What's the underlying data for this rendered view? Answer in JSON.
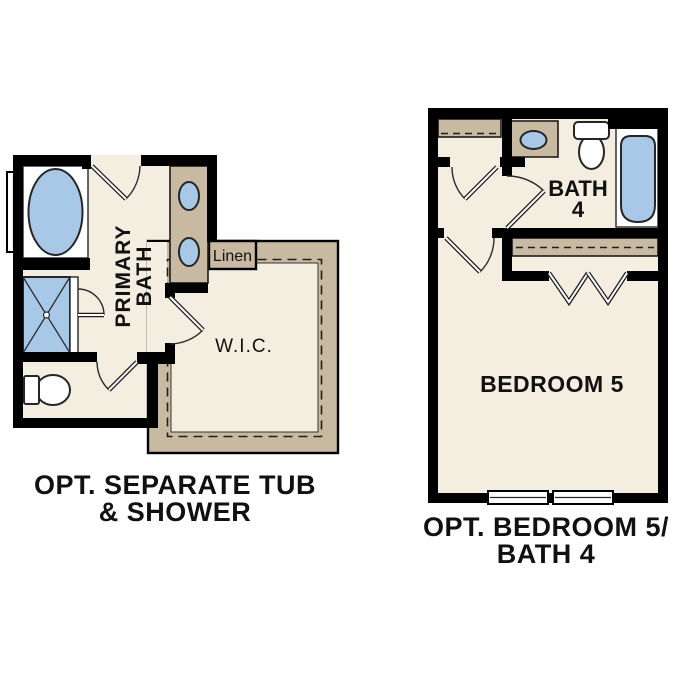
{
  "colors": {
    "paper": "#ffffff",
    "wall": "#000000",
    "floor": "#f4eee1",
    "cabinet": "#c7baa0",
    "fixture_blue": "#a8c8e8"
  },
  "left_plan": {
    "room_labels": {
      "primary_bath_line1": "PRIMARY",
      "primary_bath_line2": "BATH",
      "linen": "Linen",
      "walk_in_closet": "W.I.C."
    },
    "title": {
      "line1": "OPT. SEPARATE TUB",
      "line2": "& SHOWER"
    }
  },
  "right_plan": {
    "room_labels": {
      "bath_line1": "BATH",
      "bath_line2": "4",
      "bedroom": "BEDROOM 5"
    },
    "title": {
      "line1": "OPT. BEDROOM 5/",
      "line2": "BATH 4"
    }
  }
}
